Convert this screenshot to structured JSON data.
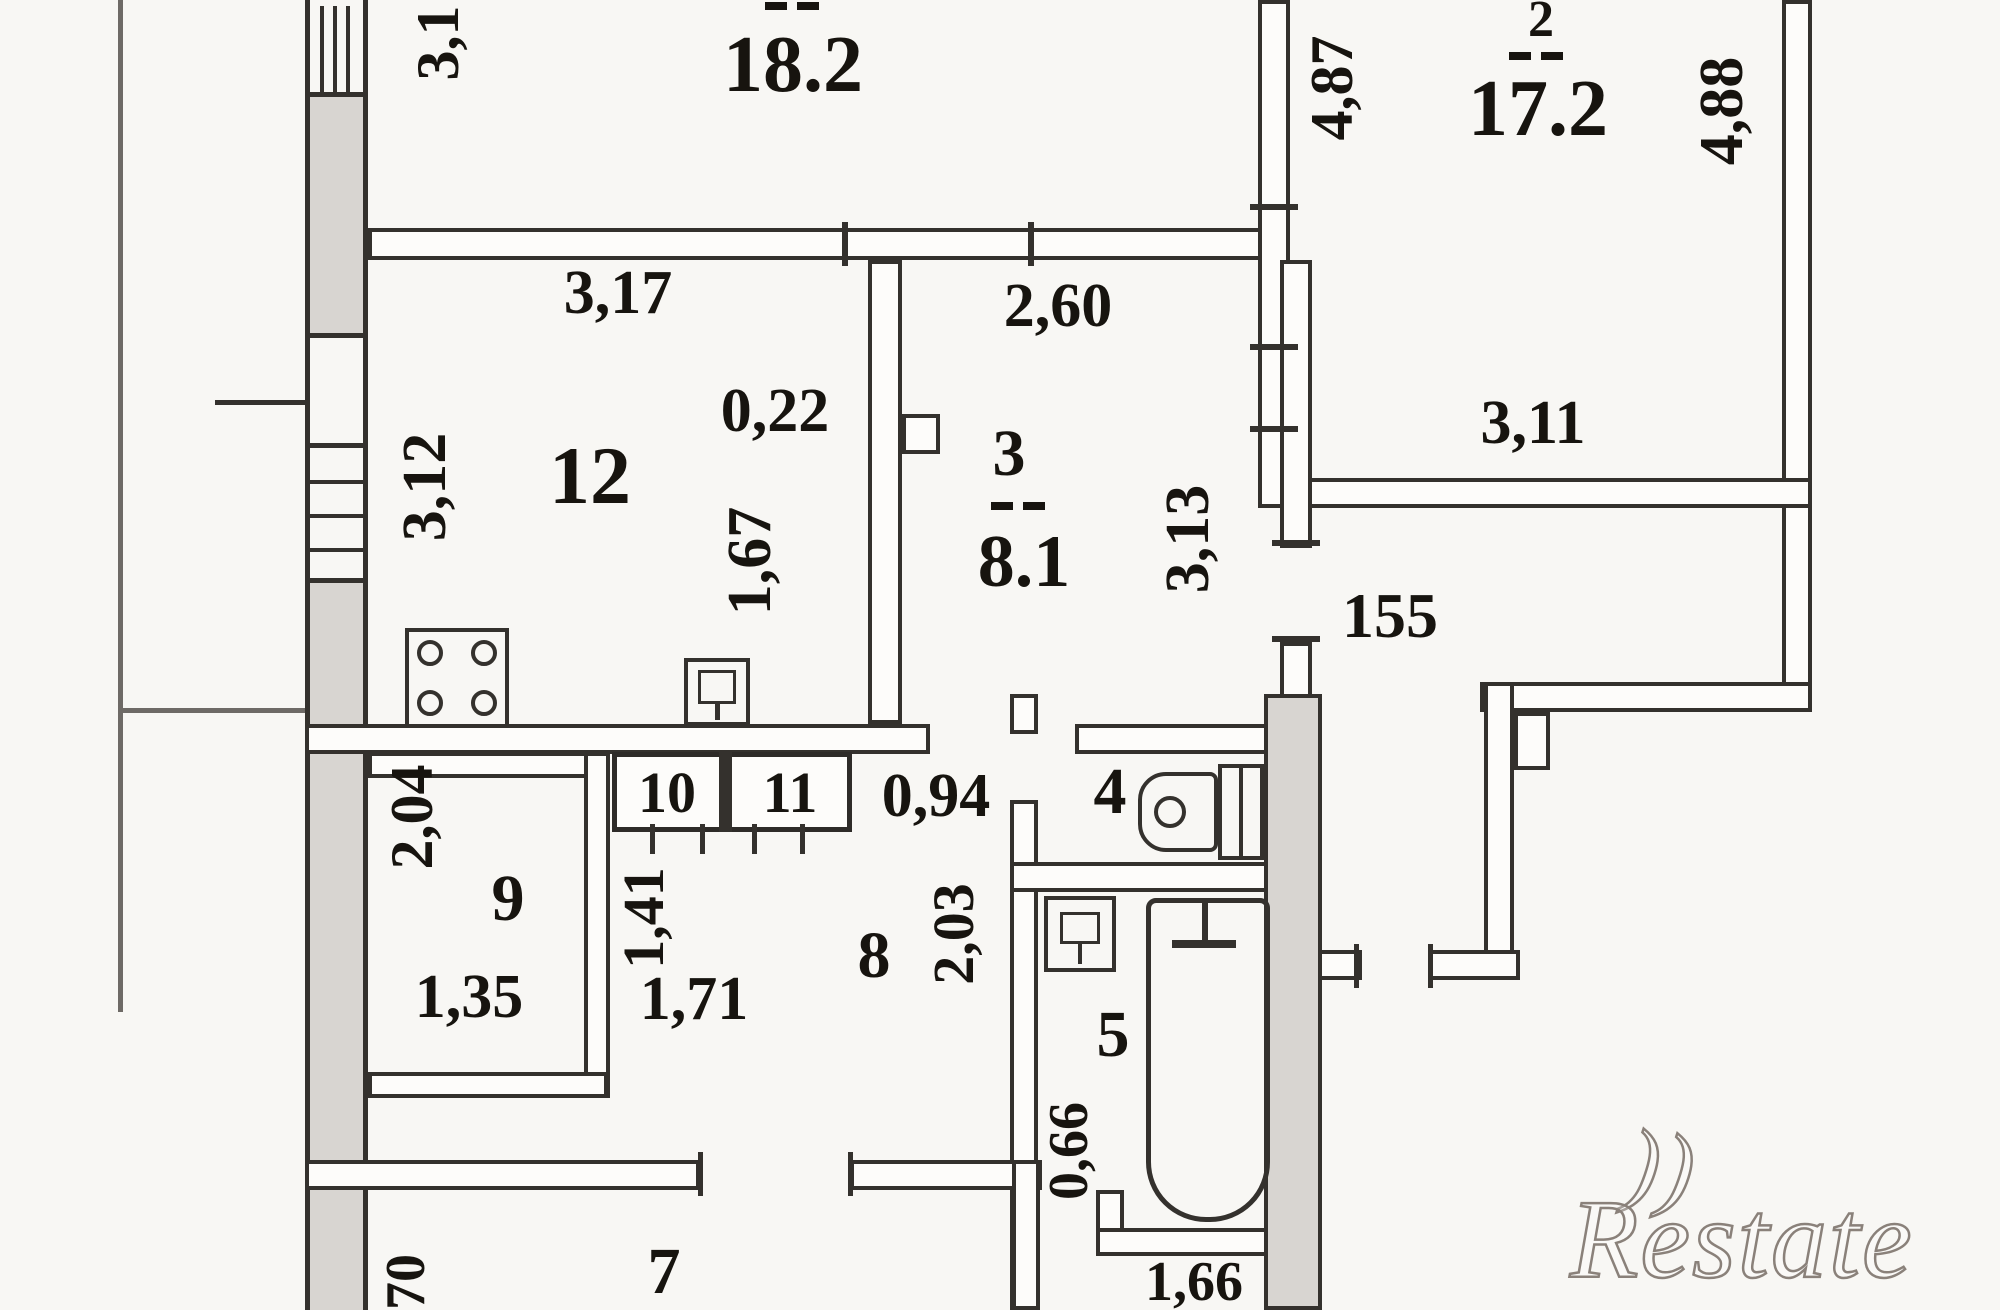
{
  "plan": {
    "labels": {
      "area_room1": "18.2",
      "num_room2": "2",
      "area_room2": "17.2",
      "num_room3": "3",
      "area_room3": "8.1",
      "num_room4": "4",
      "num_room5": "5",
      "num_room7": "7",
      "num_room8": "8",
      "num_room9": "9",
      "num_room10": "10",
      "num_room11": "11",
      "num_room12": "12",
      "d3_1": "3,1",
      "d4_87": "4,87",
      "d4_88": "4,88",
      "d3_17": "3,17",
      "d2_60": "2,60",
      "d0_22": "0,22",
      "d3_12": "3,12",
      "d1_67": "1,67",
      "d3_13": "3,13",
      "d3_11": "3,11",
      "d155": "155",
      "d0_94": "0,94",
      "d2_04": "2,04",
      "d1_35": "1,35",
      "d1_41": "1,41",
      "d1_71": "1,71",
      "d2_03": "2,03",
      "d0_66": "0,66",
      "d1_66": "1,66",
      "d70": "70"
    },
    "watermark": {
      "crescent": "))",
      "text": "Restate"
    },
    "colors": {
      "paper": "#f8f7f4",
      "wall_fill": "#d8d5d1",
      "line": "#34312d"
    }
  }
}
